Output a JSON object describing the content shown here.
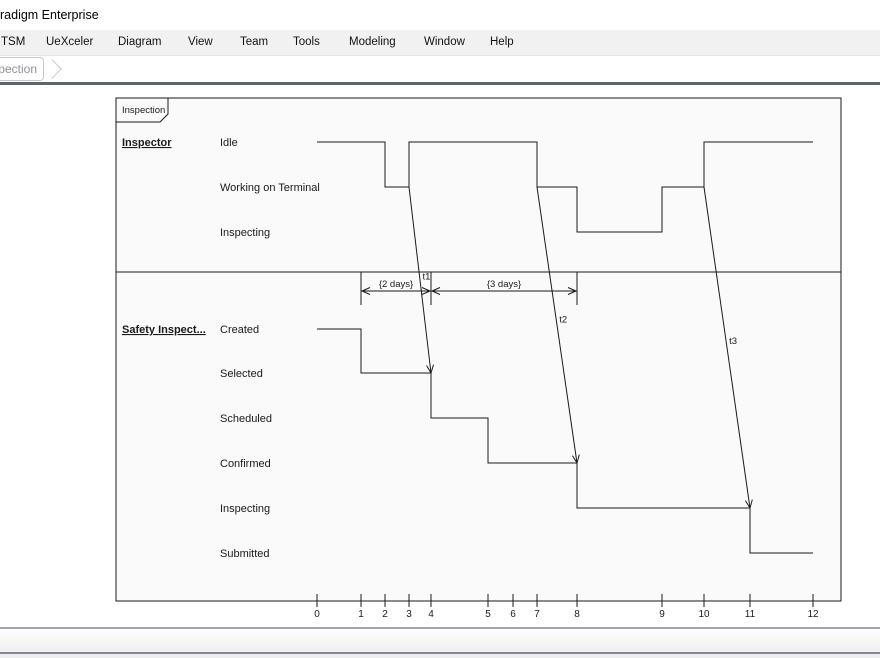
{
  "window": {
    "title": "radigm Enterprise"
  },
  "menu_bar": {
    "items": [
      {
        "label": "TSM",
        "x": 1
      },
      {
        "label": "UeXceler",
        "x": 46
      },
      {
        "label": "Diagram",
        "x": 118
      },
      {
        "label": "View",
        "x": 188
      },
      {
        "label": "Team",
        "x": 240
      },
      {
        "label": "Tools",
        "x": 293
      },
      {
        "label": "Modeling",
        "x": 349
      },
      {
        "label": "Window",
        "x": 424
      },
      {
        "label": "Help",
        "x": 490
      }
    ]
  },
  "tab_bar": {
    "active_tab_label": "pection"
  },
  "diagram": {
    "frame_label": "Inspection",
    "frame": {
      "x": 116,
      "y": 98,
      "w": 725,
      "h": 503
    },
    "separator_y": 272,
    "lifeline_label_x": 122,
    "state_label_x": 220,
    "colors": {
      "line": "#1a1a1a",
      "frame_fill": "#fafafa",
      "text": "#1a1a1a"
    },
    "ticks": [
      {
        "label": "0",
        "x": 317
      },
      {
        "label": "1",
        "x": 361
      },
      {
        "label": "2",
        "x": 385
      },
      {
        "label": "3",
        "x": 409
      },
      {
        "label": "4",
        "x": 431
      },
      {
        "label": "5",
        "x": 488
      },
      {
        "label": "6",
        "x": 513
      },
      {
        "label": "7",
        "x": 537
      },
      {
        "label": "8",
        "x": 577
      },
      {
        "label": "9",
        "x": 662
      },
      {
        "label": "10",
        "x": 704
      },
      {
        "label": "11",
        "x": 750
      },
      {
        "label": "12",
        "x": 813
      }
    ],
    "axis": {
      "y": 601,
      "tick_top": 594,
      "tick_bottom": 607,
      "label_y": 617
    },
    "lifelines": [
      {
        "name": "Inspector",
        "name_y": 142,
        "states": [
          {
            "label": "Idle",
            "y": 142
          },
          {
            "label": "Working on Terminal",
            "y": 187
          },
          {
            "label": "Inspecting",
            "y": 232
          }
        ],
        "segments": [
          {
            "state": "Idle",
            "from": 0,
            "to": 2
          },
          {
            "state": "Working on Terminal",
            "from": 2,
            "to": 3
          },
          {
            "state": "Idle",
            "from": 3,
            "to": 7
          },
          {
            "state": "Working on Terminal",
            "from": 7,
            "to": 8
          },
          {
            "state": "Inspecting",
            "from": 8,
            "to": 9
          },
          {
            "state": "Working on Terminal",
            "from": 9,
            "to": 10
          },
          {
            "state": "Idle",
            "from": 10,
            "to": 12
          }
        ]
      },
      {
        "name": "Safety Inspect...",
        "name_y": 329,
        "states": [
          {
            "label": "Created",
            "y": 329
          },
          {
            "label": "Selected",
            "y": 373
          },
          {
            "label": "Scheduled",
            "y": 418
          },
          {
            "label": "Confirmed",
            "y": 463
          },
          {
            "label": "Inspecting",
            "y": 508
          },
          {
            "label": "Submitted",
            "y": 553
          }
        ],
        "segments": [
          {
            "state": "Created",
            "from": 0,
            "to": 1
          },
          {
            "state": "Selected",
            "from": 1,
            "to": 4
          },
          {
            "state": "Scheduled",
            "from": 4,
            "to": 5
          },
          {
            "state": "Confirmed",
            "from": 5,
            "to": 8
          },
          {
            "state": "Inspecting",
            "from": 8,
            "to": 11
          },
          {
            "state": "Submitted",
            "from": 11,
            "to": 12
          }
        ]
      }
    ],
    "messages": [
      {
        "label": "t1",
        "from_lifeline": 0,
        "from_state": "Working on Terminal",
        "from_time": 3,
        "to_lifeline": 1,
        "to_state": "Selected",
        "to_time": 4
      },
      {
        "label": "t2",
        "from_lifeline": 0,
        "from_state": "Working on Terminal",
        "from_time": 7,
        "to_lifeline": 1,
        "to_state": "Confirmed",
        "to_time": 8
      },
      {
        "label": "t3",
        "from_lifeline": 0,
        "from_state": "Working on Terminal",
        "from_time": 10,
        "to_lifeline": 1,
        "to_state": "Inspecting",
        "to_time": 11
      }
    ],
    "duration_constraints": {
      "arrow_y": 291,
      "label_y": 287,
      "vertical_top": 272,
      "vertical_bottom": 305,
      "items": [
        {
          "label": "{2 days}",
          "from_time": 1,
          "to_time": 4
        },
        {
          "label": "{3 days}",
          "from_time": 4,
          "to_time": 8
        }
      ]
    }
  },
  "status_bar": {
    "text": ""
  }
}
